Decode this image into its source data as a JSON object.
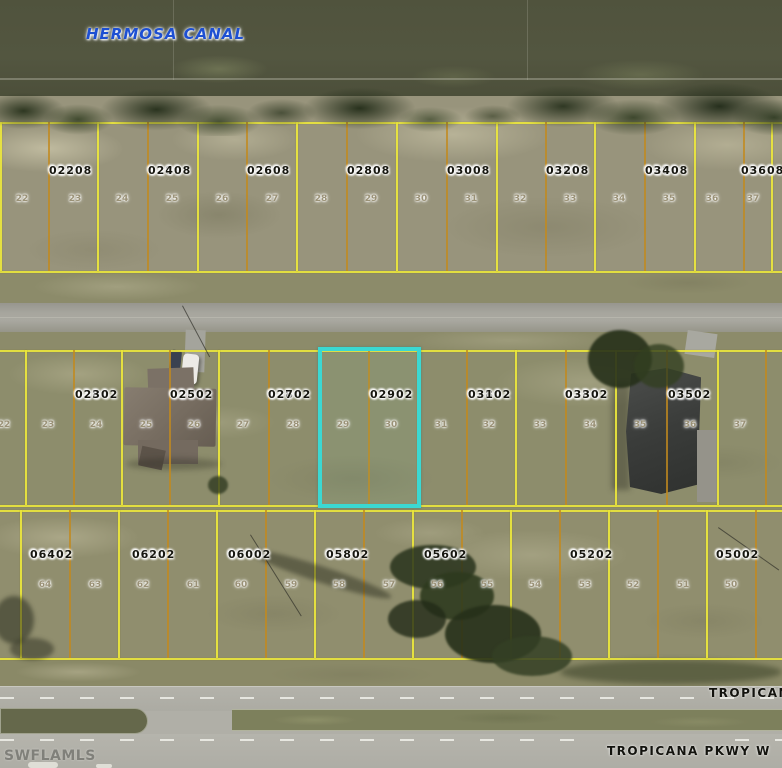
{
  "labels": {
    "canal": "HERMOSA CANAL",
    "street_bottom": "TROPICANA PKWY W",
    "street_right": "TROPICANA PKWY W",
    "watermark": "SWFLAMLS"
  },
  "highlight": {
    "parcel": "02842 0290",
    "color": "#3bd8d2"
  },
  "colors": {
    "parcel_boundary": "#ece73c",
    "lot_line": "#c2891e",
    "canal_text": "#1d4fd2",
    "canal_water": "#50533d"
  },
  "rows": [
    {
      "id": "north",
      "parcels": [
        {
          "line1": "02898",
          "line2": "0220",
          "lots": [
            "22",
            "23"
          ]
        },
        {
          "line1": "02898",
          "line2": "0240",
          "lots": [
            "24",
            "25"
          ]
        },
        {
          "line1": "02898",
          "line2": "0260",
          "lots": [
            "26",
            "27"
          ]
        },
        {
          "line1": "02898",
          "line2": "0280",
          "lots": [
            "28",
            "29"
          ]
        },
        {
          "line1": "02898",
          "line2": "0300",
          "lots": [
            "30",
            "31"
          ]
        },
        {
          "line1": "02898",
          "line2": "0320",
          "lots": [
            "32",
            "33"
          ]
        },
        {
          "line1": "02898",
          "line2": "0340",
          "lots": [
            "34",
            "35"
          ]
        },
        {
          "line1": "02898",
          "line2": "0360",
          "lots": [
            "36",
            "37"
          ]
        }
      ]
    },
    {
      "id": "middle",
      "edge_lot_left": "22",
      "parcels": [
        {
          "line1": "02842",
          "line2": "0230",
          "lots": [
            "23",
            "24"
          ]
        },
        {
          "line1": "02842",
          "line2": "0250",
          "lots": [
            "25",
            "26"
          ]
        },
        {
          "line1": "02842",
          "line2": "0270",
          "lots": [
            "27",
            "28"
          ]
        },
        {
          "line1": "02842",
          "line2": "0290",
          "lots": [
            "29",
            "30"
          ],
          "highlighted": true
        },
        {
          "line1": "02842",
          "line2": "0310",
          "lots": [
            "31",
            "32"
          ]
        },
        {
          "line1": "02842",
          "line2": "0330",
          "lots": [
            "33",
            "34"
          ]
        },
        {
          "line1": "02842",
          "line2": "0350",
          "lots": [
            "35",
            "36"
          ]
        },
        {
          "line1": "02842",
          "line2": "0370",
          "lots": [
            "37"
          ],
          "partial": true
        }
      ]
    },
    {
      "id": "south",
      "parcels": [
        {
          "line1": "02842",
          "line2": "0640",
          "lots": [
            "64",
            "63"
          ]
        },
        {
          "line1": "02842",
          "line2": "0620",
          "lots": [
            "62",
            "61"
          ]
        },
        {
          "line1": "02842",
          "line2": "0600",
          "lots": [
            "60",
            "59"
          ]
        },
        {
          "line1": "02842",
          "line2": "0580",
          "lots": [
            "58",
            "57"
          ]
        },
        {
          "line1": "02842",
          "line2": "0560",
          "lots": [
            "56",
            "55"
          ]
        },
        {
          "line1": "",
          "line2": "",
          "lots": [
            "54",
            "53"
          ]
        },
        {
          "line1": "02842",
          "line2": "0520",
          "lots": [
            "52",
            "51"
          ]
        },
        {
          "line1": "02842",
          "line2": "0500",
          "lots": [
            "50"
          ]
        }
      ]
    }
  ]
}
